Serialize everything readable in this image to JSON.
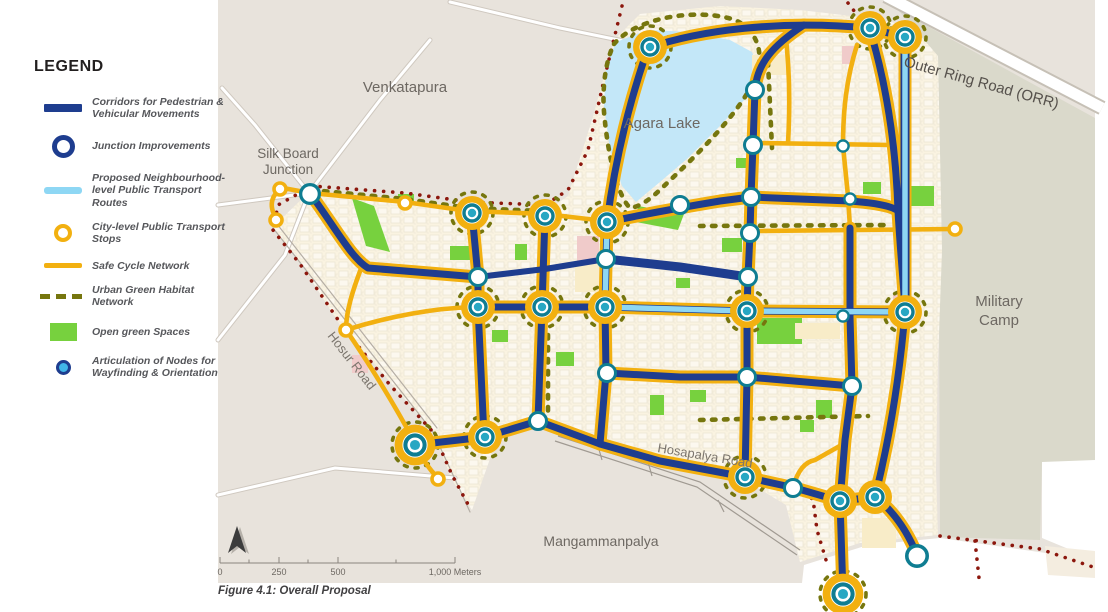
{
  "figure": {
    "caption": "Figure 4.1: Overall Proposal"
  },
  "legend": {
    "title": "LEGEND",
    "items": [
      {
        "icon": "corridor-line-swatch",
        "label": "Corridors for Pedestrian & Vehicular Movements"
      },
      {
        "icon": "junction-ring-swatch",
        "label": "Junction Improvements"
      },
      {
        "icon": "transit-line-swatch",
        "label": "Proposed Neighbourhood-level Public Transport Routes"
      },
      {
        "icon": "transport-stop-swatch",
        "label": "City-level Public Transport Stops"
      },
      {
        "icon": "cycle-line-swatch",
        "label": "Safe Cycle Network"
      },
      {
        "icon": "green-habitat-dash-swatch",
        "label": "Urban Green Habitat Network"
      },
      {
        "icon": "open-green-swatch",
        "label": "Open green Spaces"
      },
      {
        "icon": "wayfinding-node-swatch",
        "label": "Articulation of Nodes for Wayfinding & Orientation"
      }
    ]
  },
  "map": {
    "labels": {
      "venkatapura": "Venkatapura",
      "agara_lake": "Agara Lake",
      "silk_board_1": "Silk Board",
      "silk_board_2": "Junction",
      "hosur_road": "Hosur Road",
      "military_camp_1": "Military",
      "military_camp_2": "Camp",
      "mangammanpalya": "Mangammanpalya",
      "outer_ring_road": "Outer Ring Road (ORR)",
      "hosapalya_road": "Hosapalya  Road"
    },
    "scale": {
      "ticks": [
        "0",
        "250",
        "500"
      ],
      "end": "1,000 Meters"
    }
  },
  "colors": {
    "corridor_navy": "#1e3d8f",
    "transit_light_blue": "#8ed7f4",
    "cycle_yellow": "#f2b010",
    "habitat_olive": "#76760e",
    "open_green": "#77d13e",
    "junction_teal": "#0f7d92",
    "node_teal_fill": "#28a7c3",
    "lake_blue": "#c3e7f8",
    "boundary_red": "#8c170d",
    "camp_gray": "#dad9cb",
    "base_gray": "#e8e3dc",
    "urban_cream": "#faf3e1"
  }
}
